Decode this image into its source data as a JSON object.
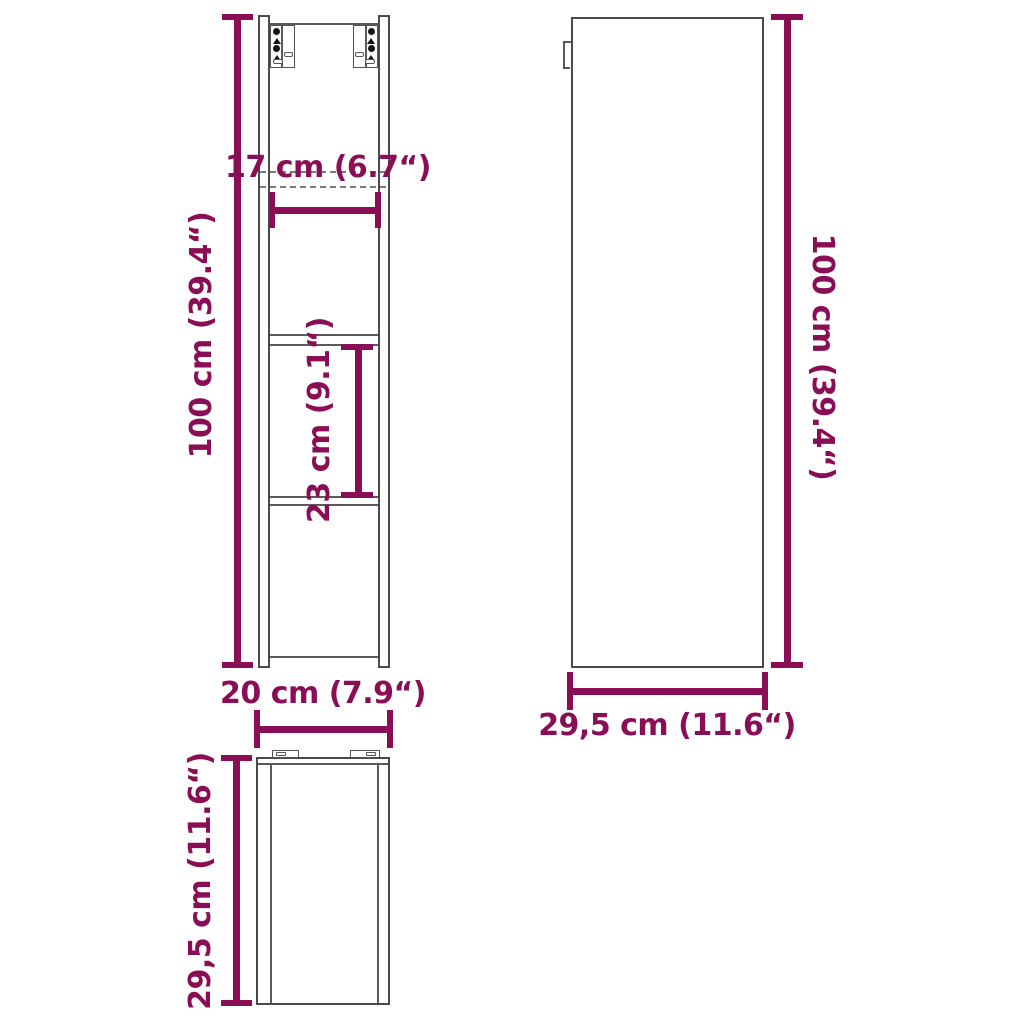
{
  "figure": {
    "type": "furniture-dimension-diagram",
    "accent_color": "#8A0E56",
    "line_color": "#4A4A4A"
  },
  "views": {
    "front": {
      "height_label": "100 cm (39.4“)",
      "top_width_label": "17 cm (6.7“)",
      "shelf_spacing_label": "23 cm (9.1“)",
      "width_label": "20 cm (7.9“)"
    },
    "side": {
      "height_label": "100 cm (39.4“)",
      "depth_label": "29,5 cm (11.6“)"
    },
    "top": {
      "depth_label": "29,5 cm (11.6“)"
    }
  }
}
